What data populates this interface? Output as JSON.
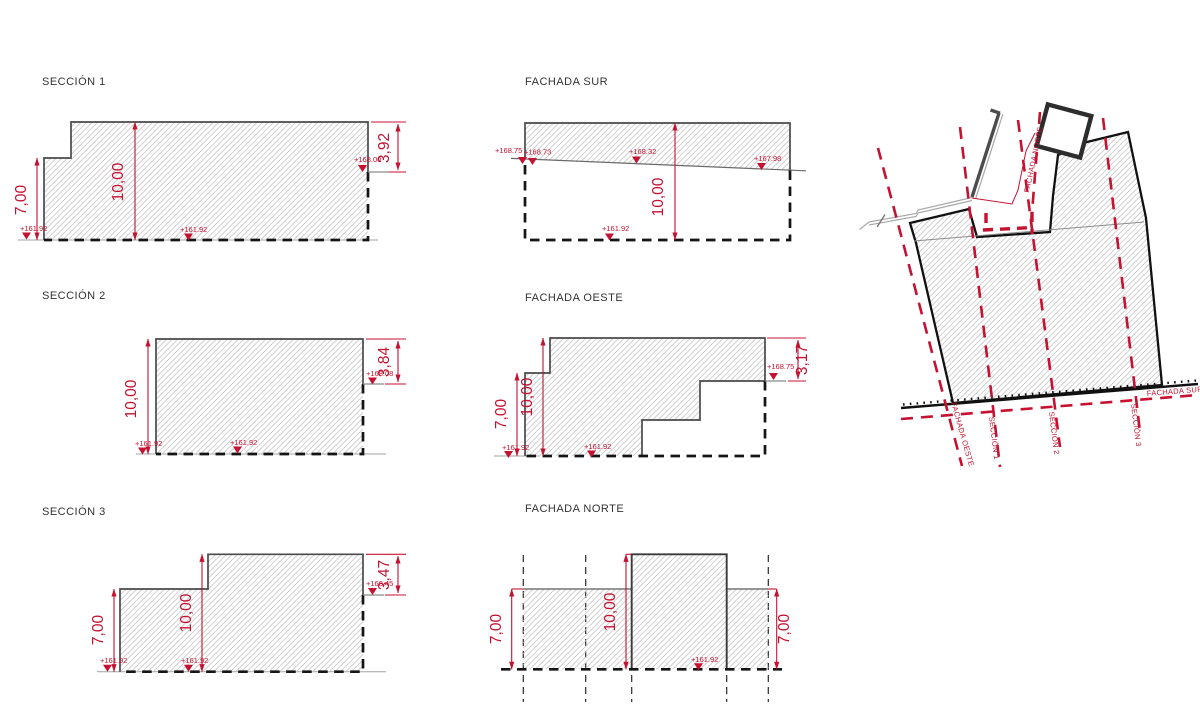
{
  "colors": {
    "accent_red": "#c41230",
    "outline_gray": "#4a4a4a",
    "below_grade_black": "#151515",
    "hatch_gray": "#cbcbcb",
    "background": "#ffffff"
  },
  "seccion1": {
    "title": "SECCIÓN 1",
    "dims": {
      "left": "7,00",
      "height": "10,00",
      "parapet": "3,92"
    },
    "levels": {
      "ground_left": "+161.92",
      "ground_mid": "+161.92",
      "ledge": "+168.00"
    }
  },
  "fachada_sur": {
    "title": "FACHADA SUR",
    "dims": {
      "height": "10,00"
    },
    "levels": {
      "corner_a": "+168.75",
      "corner_b": "+168.73",
      "mid": "+168.32",
      "right": "+167.98",
      "ground": "+161.92"
    }
  },
  "seccion2": {
    "title": "SECCIÓN 2",
    "dims": {
      "height": "10,00",
      "parapet": "3,84"
    },
    "levels": {
      "ledge": "+168.08",
      "ground_left": "+161.92",
      "ground_mid": "+161.92"
    }
  },
  "fachada_oeste": {
    "title": "FACHADA OESTE",
    "dims": {
      "left": "7,00",
      "height": "10,00",
      "parapet": "3,17"
    },
    "levels": {
      "ledge": "+168.75",
      "ground_left": "+161.92",
      "ground_mid": "+161.92"
    }
  },
  "seccion3": {
    "title": "SECCIÓN 3",
    "dims": {
      "left": "7,00",
      "height": "10,00",
      "parapet": "3,47"
    },
    "levels": {
      "ledge": "+168.45",
      "ground_left": "+161.92",
      "ground_mid": "+161.92"
    }
  },
  "fachada_norte": {
    "title": "FACHADA NORTE",
    "dims": {
      "left": "7,00",
      "height": "10,00",
      "right": "7,00"
    },
    "levels": {
      "ground": "+161.92"
    }
  },
  "site_plan": {
    "labels": {
      "fachada_oeste": "FACHADA OESTE",
      "seccion_1": "SECCIÓN 1",
      "seccion_2": "SECCIÓN 2",
      "seccion_3": "SECCIÓN 3",
      "fachada_norte": "FACHADA NORTE",
      "fachada_sur": "FACHADA SUR"
    }
  }
}
